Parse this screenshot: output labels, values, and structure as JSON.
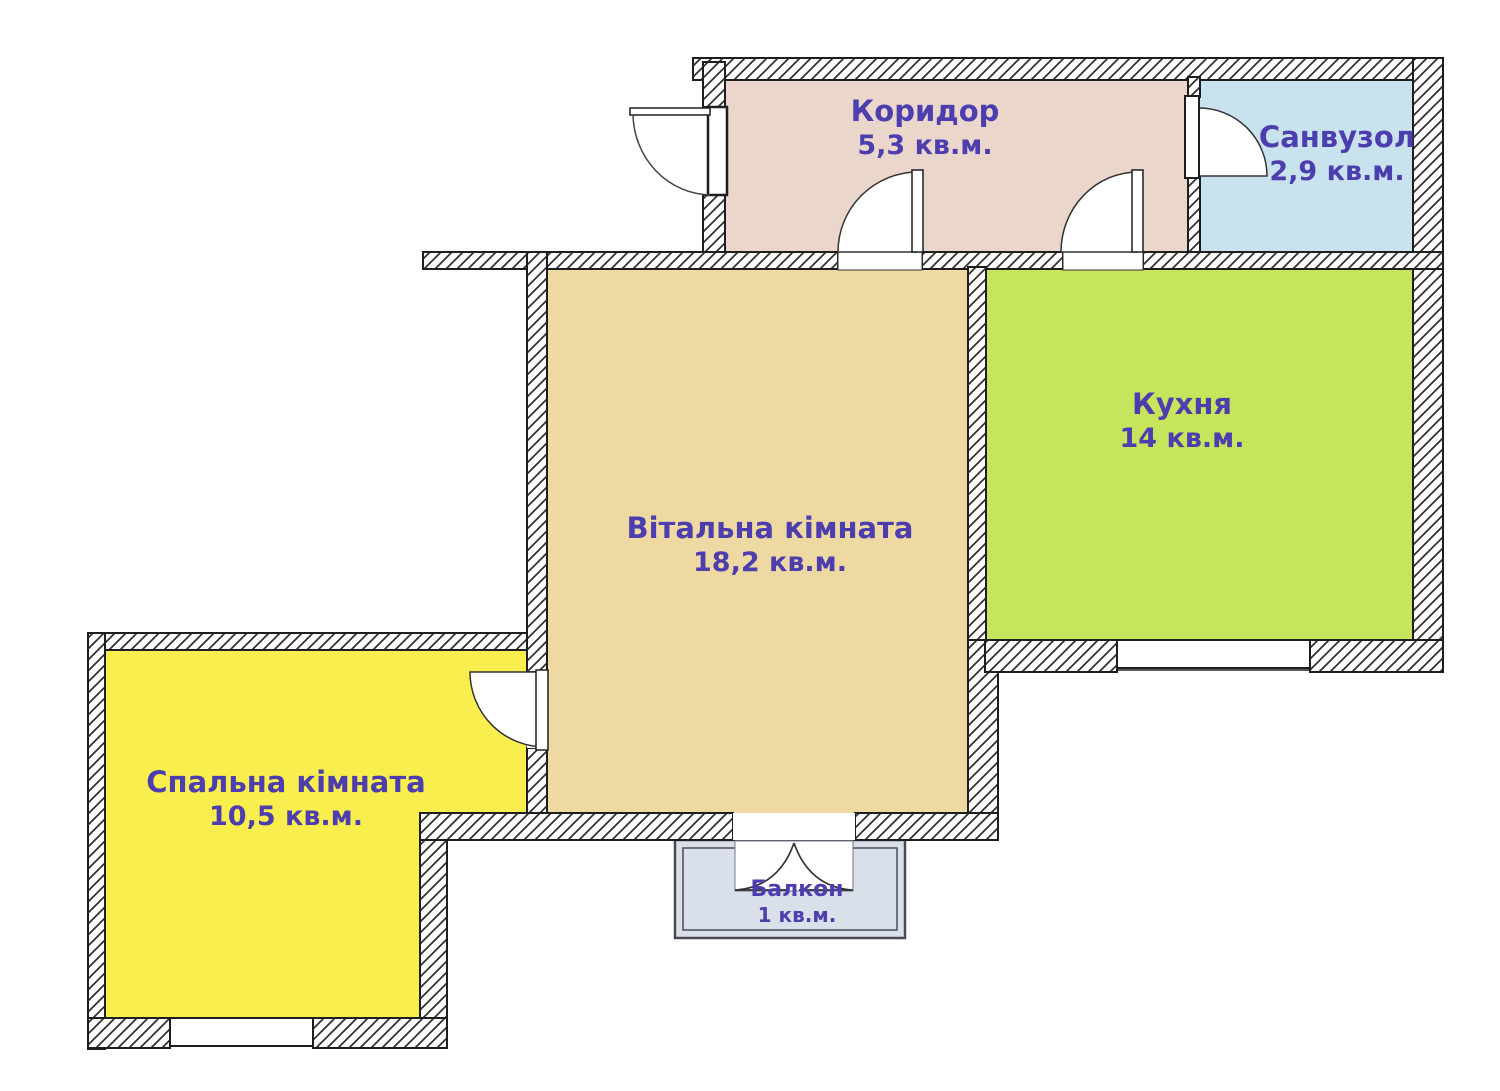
{
  "plan_title": "План квартири",
  "colors": {
    "background": "#ffffff",
    "label_text": "#4c3eae",
    "wall_outline": "#1e1e1e",
    "hatch": "#2e2e2e",
    "balcony_border": "#4a4a55",
    "door_line": "#333333"
  },
  "rooms": [
    {
      "id": "corridor",
      "name": "Коридор",
      "area": "5,3 кв.м.",
      "color": "#ead6ca"
    },
    {
      "id": "bathroom",
      "name": "Санвузол",
      "area": "2,9 кв.м.",
      "color": "#c9e3ee"
    },
    {
      "id": "kitchen",
      "name": "Кухня",
      "area": "14 кв.м.",
      "color": "#c6e45c"
    },
    {
      "id": "living-room",
      "name": "Вітальна кімната",
      "area": "18,2 кв.м.",
      "color": "#eed9a2"
    },
    {
      "id": "bedroom",
      "name": "Спальна кімната",
      "area": "10,5 кв.м.",
      "color": "#f8ee4e"
    },
    {
      "id": "balcony",
      "name": "Балкон",
      "area": "1 кв.м.",
      "color": "#d9e0ea"
    }
  ]
}
